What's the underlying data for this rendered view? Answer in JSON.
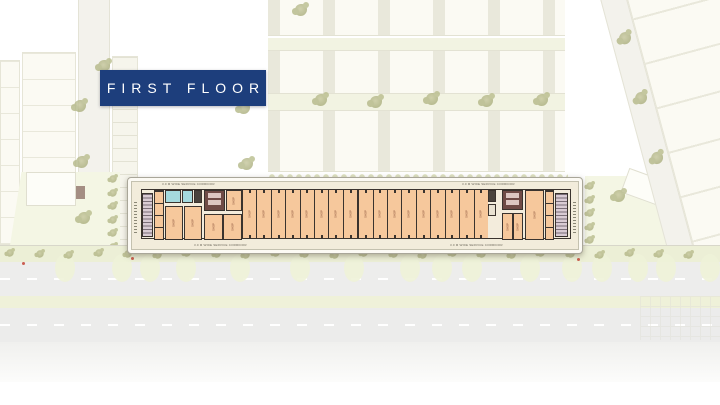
{
  "banner": {
    "title": "FIRST FLOOR"
  },
  "plan": {
    "corridor_labels": {
      "top_left": "3.0 M WIDE SERVICE CORRIDOR",
      "top_right": "3.0 M WIDE SERVICE CORRIDOR",
      "bottom_left": "3.0 M WIDE SERVICE CORRIDOR",
      "bottom_right": "3.0 M WIDE SERVICE CORRIDOR"
    },
    "left_wing": {
      "shops": [
        "SHOP",
        "SHOP",
        "SHOP",
        "SHOP",
        "SHOP"
      ]
    },
    "narrow_shops": [
      "SHOP",
      "SHOP",
      "SHOP",
      "SHOP",
      "SHOP",
      "SHOP",
      "SHOP",
      "SHOP",
      "SHOP",
      "SHOP",
      "SHOP",
      "SHOP",
      "SHOP",
      "SHOP",
      "SHOP",
      "SHOP",
      "SHOP"
    ],
    "right_wing": {
      "shops": [
        "SHOP",
        "SHOP",
        "SHOP"
      ]
    }
  },
  "colors": {
    "banner_bg": "#1d3e7c",
    "banner_text": "#ffffff",
    "board_bg": "#f2ecdb",
    "shop_fill": "#f6c89c",
    "wall": "#3a332e",
    "toilet_fill": "#a5dade",
    "lobby_fill": "#6f4b46",
    "stair_fill": "#d9cbd4",
    "tree_olive": "#abaf7e",
    "road_fill": "#ededec",
    "median_fill": "#eff1d9",
    "field_green": "#f4f6e4"
  }
}
